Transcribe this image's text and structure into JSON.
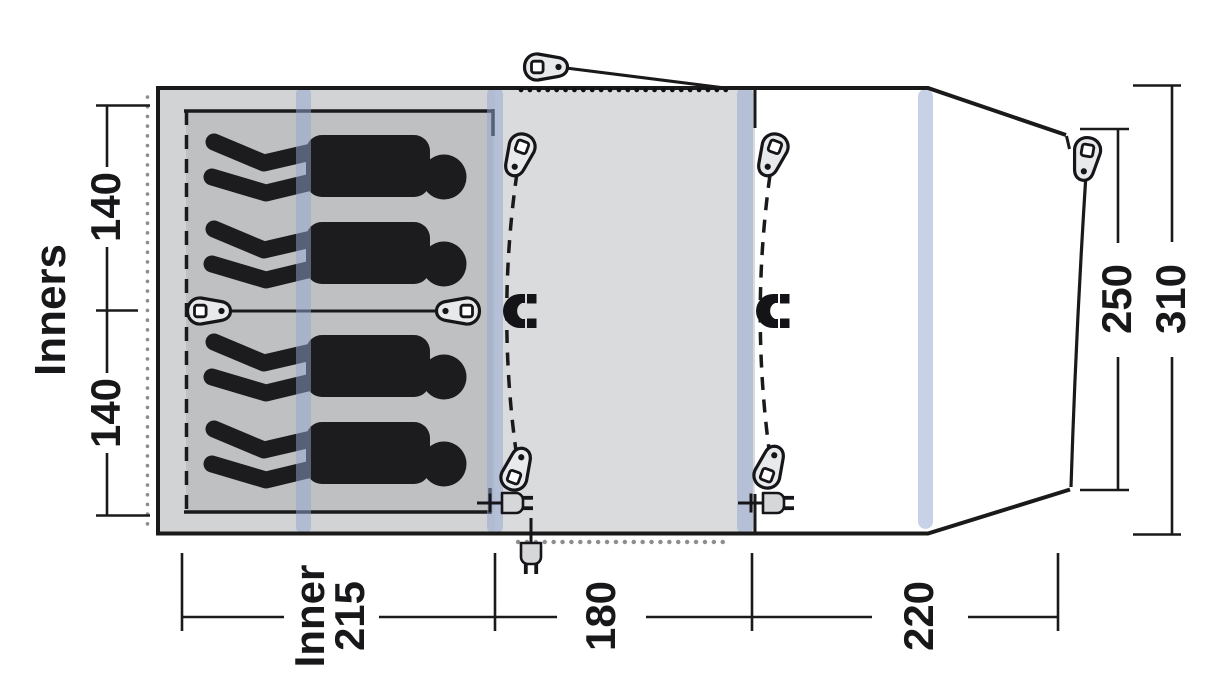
{
  "diagram": {
    "type": "tent floor plan (top view)",
    "side_label": "Inners",
    "dimensions": {
      "bedroom_width_top_cm": "140",
      "bedroom_width_bottom_cm": "140",
      "inner_length_label": "Inner",
      "inner_length_cm": "215",
      "living_area_length_cm": "180",
      "front_area_length_cm": "220",
      "front_inner_width_cm": "250",
      "front_total_width_cm": "310"
    },
    "elements": {
      "sleeping_figures": 4,
      "air_pole_stripes": 4,
      "zip_pull_icons": 8,
      "magnet_closure_icons": 2,
      "power_inlet_icons": 3,
      "guyline_icons": 1
    },
    "colors": {
      "outline": "#1a1a1a",
      "inner_section_fill": "#d2d3d4",
      "inner_floor_fill": "#bfc0c1",
      "living_section_fill": "#dadbdc",
      "front_section_fill": "#ffffff",
      "pole_stripe": "#8fa5d2",
      "figure_fill": "#1c1c1e",
      "dotted_gray": "#8d8d8d"
    }
  }
}
